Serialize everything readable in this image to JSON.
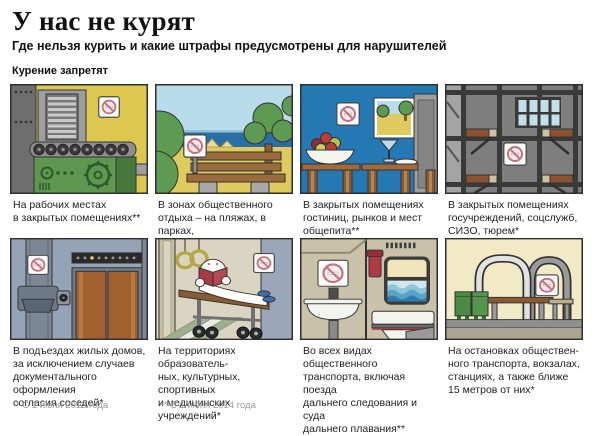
{
  "header": {
    "title": "У нас не курят",
    "subtitle": "Где нельзя курить и какие штрафы предусмотрены для нарушителей"
  },
  "section_label": "Курение запретят",
  "panels": [
    {
      "id": "workplace",
      "caption": "На рабочих местах\nв закрытых помещениях**"
    },
    {
      "id": "recreation-zones",
      "caption": "В зонах общественного\nотдыха – на пляжах, в парках,\nна детских площадках*"
    },
    {
      "id": "hotels-markets-catering",
      "caption": "В закрытых помещениях\nгостиниц, рынков и мест\nобщепита**"
    },
    {
      "id": "state-institutions",
      "caption": "В закрытых помещениях\nгосучреждений, соцслужб,\nСИЗО, тюрем*"
    },
    {
      "id": "residential-entrances",
      "caption": "В подъездах жилых домов,\nза исключением случаев\nдокументального оформления\nсогласия соседей*"
    },
    {
      "id": "edu-culture-sport-med",
      "caption": "На территориях образователь-\nных, культурных, спортивных\nи медицинских учреждений*"
    },
    {
      "id": "public-transport",
      "caption": "Во всех видах общественного\nтранспорта, включая поезда\nдальнего следования и суда\nдальнего плавания**"
    },
    {
      "id": "transport-stops",
      "caption": "На остановках обществен-\nного транспорта, вокзалах,\nстанциях, а также ближе\n15 метров от них*"
    }
  ],
  "footnotes": {
    "one_star": "* С 1 июня 2013 года",
    "two_star": "** С 1 июня 2014 года"
  },
  "icons": {
    "no_smoking": "no-smoking-prohibition-sign"
  },
  "palette": {
    "prohibition_red": "#c4717d",
    "panel_border": "#2f2f2f",
    "factory_yellow": "#dcc851",
    "cafe_blue": "#2478b4",
    "sea_blue": "#2a6ea6",
    "footnote_gray": "#9a9a9a"
  }
}
